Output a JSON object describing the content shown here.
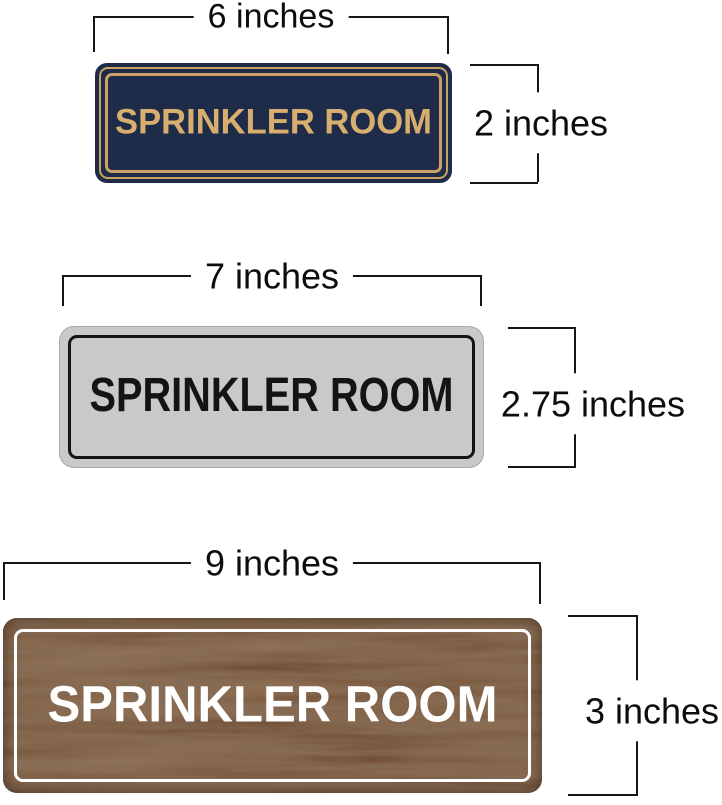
{
  "signs": [
    {
      "style": "navy-gold",
      "label": "SPRINKLER ROOM",
      "width_label": "6 inches",
      "height_label": "2 inches",
      "colors": {
        "background": "#1e2b49",
        "border": "#c9a264",
        "text": "#d7ae6e"
      }
    },
    {
      "style": "silver-black",
      "label": "SPRINKLER ROOM",
      "width_label": "7 inches",
      "height_label": "2.75 inches",
      "colors": {
        "background": "#c9c9cb",
        "border": "#141414",
        "text": "#141414"
      }
    },
    {
      "style": "walnut-wood",
      "label": "SPRINKLER ROOM",
      "width_label": "9 inches",
      "height_label": "3 inches",
      "colors": {
        "background": "#5e4129",
        "border": "#ffffff",
        "text": "#ffffff"
      }
    }
  ],
  "dimension_lines": {
    "color": "#161616",
    "label_color": "#0d0d0d"
  }
}
